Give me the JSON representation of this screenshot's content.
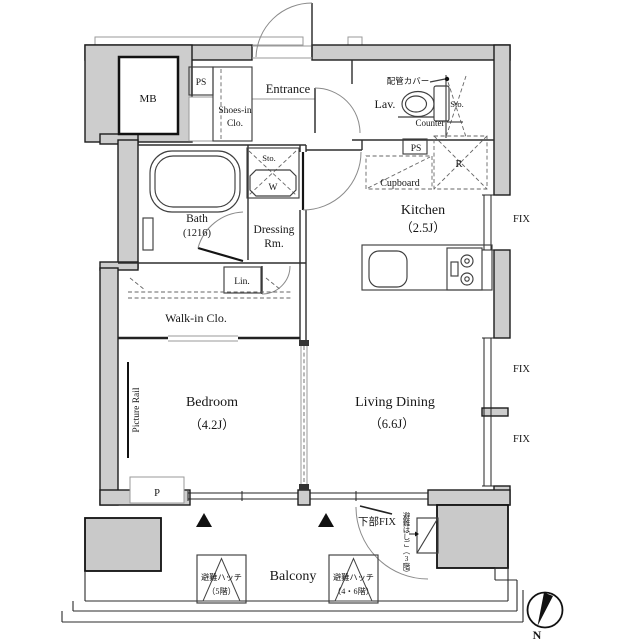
{
  "plan_type": "apartment-floor-plan",
  "colors": {
    "wall_fill": "#cdcdcd",
    "line": "#1c1c1c",
    "background": "#ffffff"
  },
  "rooms": {
    "entrance": {
      "label": "Entrance"
    },
    "shoes_closet": {
      "line1": "Shoes-in",
      "line2": "Clo."
    },
    "lavatory": {
      "label": "Lav."
    },
    "kitchen": {
      "label": "Kitchen",
      "size": "（2.5J）"
    },
    "bath": {
      "label": "Bath",
      "size": "(1216)"
    },
    "dressing": {
      "line1": "Dressing",
      "line2": "Rm."
    },
    "walk_in_closet": {
      "label": "Walk-in Clo."
    },
    "bedroom": {
      "label": "Bedroom",
      "size": "（4.2J）"
    },
    "living_dining": {
      "label": "Living Dining",
      "size": "（6.6J）"
    },
    "balcony": {
      "label": "Balcony"
    }
  },
  "fixtures": {
    "mb": "MB",
    "ps_top": "PS",
    "ps_kitchen": "PS",
    "storage_lav": "Sto.",
    "storage_dressing": "Sto.",
    "washer": "W",
    "counter": "Counter",
    "pipe_cover": "配管カバー",
    "cupboard": "Cupboard",
    "refrigerator": "R",
    "linen": "Lin.",
    "picture_rail": "Picture Rail",
    "pole": "P"
  },
  "annotations": {
    "fix1": "FIX",
    "fix2": "FIX",
    "fix3": "FIX",
    "lower_fix": "下部FIX",
    "evac_ladder": "避難はしご（3階）",
    "hatch_5f": {
      "line1": "避難ハッチ",
      "line2": "（5階）"
    },
    "hatch_46f": {
      "line1": "避難ハッチ",
      "line2": "（4・6階）"
    },
    "compass_north": "N"
  }
}
